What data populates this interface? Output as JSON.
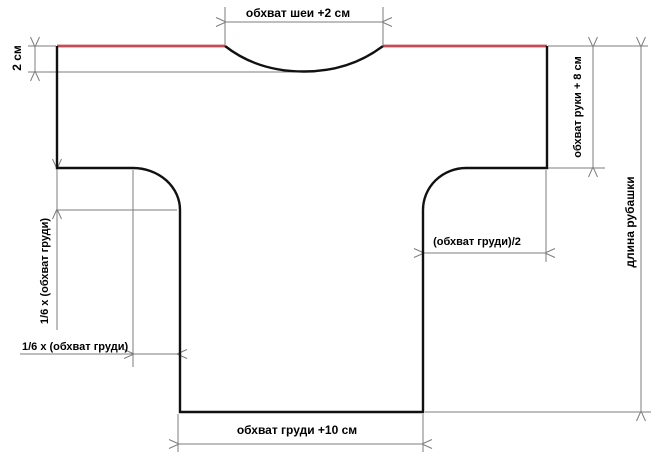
{
  "colors": {
    "background": "#ffffff",
    "outline": "#111111",
    "dimension": "#7d7d7d",
    "shoulder_line": "#c84a54",
    "text": "#000000"
  },
  "labels": {
    "neck": "обхват шеи +2 см",
    "hem_allowance": "2 см",
    "sleeve_width": "обхват руки + 8 см",
    "shirt_length": "длина рубашки",
    "half_chest": "(обхват груди)/2",
    "sixth_chest_vertical": "1/6 х (обхват груди)",
    "sixth_chest_horizontal": "1/6 x (обхват груди)",
    "chest_bottom": "обхват груди +10 см"
  }
}
